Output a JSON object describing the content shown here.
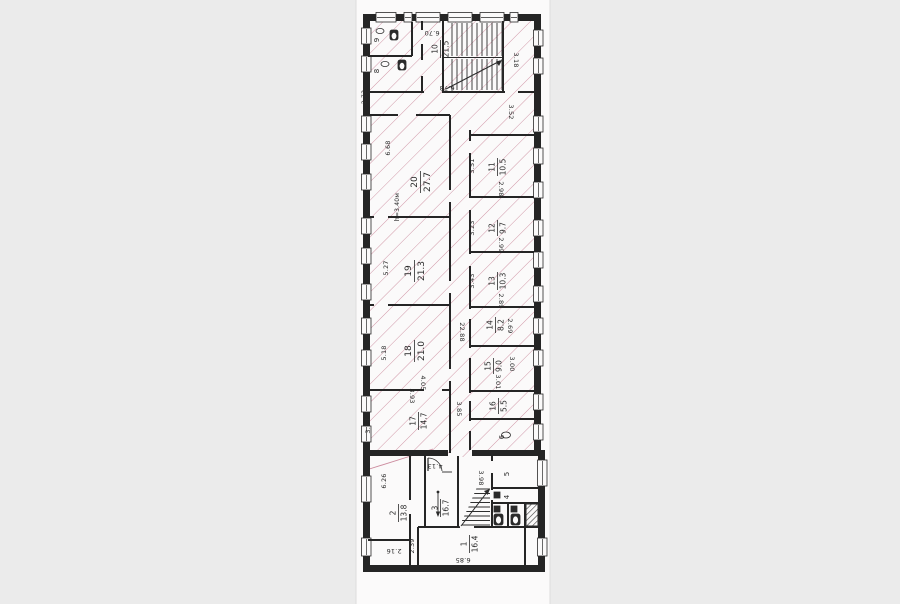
{
  "palette": {
    "margin_bg": "#ebebeb",
    "paper": "#fbfafa",
    "ink": "#252525",
    "hatch_pink": "#c4798f"
  },
  "rooms": {
    "r1": {
      "num": "1",
      "area": "16.4"
    },
    "r2": {
      "num": "2",
      "area": "13.8"
    },
    "r3": {
      "num": "3",
      "area": "16.7"
    },
    "r4": {
      "num": "4"
    },
    "r5": {
      "num": "5"
    },
    "r6": {
      "num": "6"
    },
    "r8": {
      "num": "8"
    },
    "r9": {
      "num": "9"
    },
    "r10": {
      "num": "10",
      "area": "21.5"
    },
    "r11": {
      "num": "11",
      "area": "10.5"
    },
    "r12": {
      "num": "12",
      "area": "9.7"
    },
    "r13": {
      "num": "13",
      "area": "10.3"
    },
    "r14": {
      "num": "14",
      "area": "8.2"
    },
    "r15": {
      "num": "15",
      "area": "9.0"
    },
    "r16": {
      "num": "16",
      "area": "5.5"
    },
    "r17": {
      "num": "17",
      "area": "14.7"
    },
    "r18": {
      "num": "18",
      "area": "21.0"
    },
    "r19": {
      "num": "19",
      "area": "21.3"
    },
    "r20": {
      "num": "20",
      "area": "27.7"
    }
  },
  "dims": {
    "d670": "6.70",
    "d678": "6.78",
    "d318": "3.18",
    "d352": "3.52",
    "d273": "2.73",
    "d668": "6.68",
    "h340": "h=3.40м",
    "d527": "5.27",
    "d518": "5.18",
    "d373": "3.73",
    "d405": "4.05",
    "d393": "3.93",
    "d385": "3.85",
    "d2288": "22.88",
    "d351": "3.51",
    "d298": "2.98",
    "d323": "3.23",
    "d299": "2.99",
    "d343": "3.43",
    "d289": "2.89",
    "d269": "2.69",
    "d300": "3.00",
    "d301": "3.01",
    "d626": "6.26",
    "d216": "2.16",
    "d239": "2.39",
    "d413": "4.13",
    "d398": "3.98",
    "d685": "6.85"
  }
}
